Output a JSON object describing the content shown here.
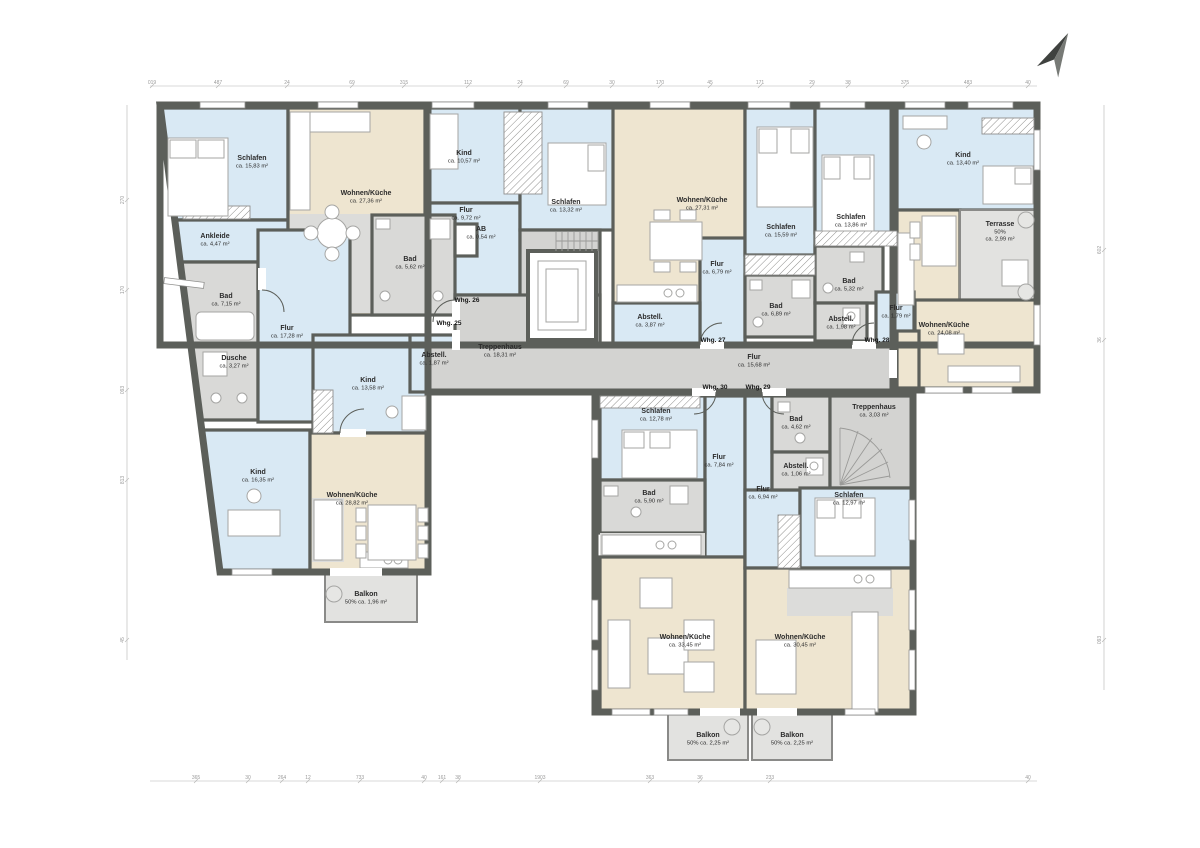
{
  "rooms": [
    {
      "id": "schlafen25",
      "name": "Schlafen",
      "area": "ca. 15,83 m²"
    },
    {
      "id": "wk25",
      "name": "Wohnen/Küche",
      "area": "ca. 27,36 m²"
    },
    {
      "id": "ankleide25",
      "name": "Ankleide",
      "area": "ca. 4,47 m²"
    },
    {
      "id": "bad25",
      "name": "Bad",
      "area": "ca. 7,15 m²"
    },
    {
      "id": "dusche25",
      "name": "Dusche",
      "area": "ca. 3,27 m²"
    },
    {
      "id": "flur25",
      "name": "Flur",
      "area": "ca. 17,28 m²"
    },
    {
      "id": "kind25a",
      "name": "Kind",
      "area": "ca. 13,58 m²"
    },
    {
      "id": "abstell25",
      "name": "Abstell.",
      "area": "ca. 1,87 m²"
    },
    {
      "id": "kind25b",
      "name": "Kind",
      "area": "ca. 16,35 m²"
    },
    {
      "id": "wk25b",
      "name": "Wohnen/Küche",
      "area": "ca. 28,82 m²"
    },
    {
      "id": "balkon25",
      "name": "Balkon",
      "area": "50% ca. 1,96 m²"
    },
    {
      "id": "kind26",
      "name": "Kind",
      "area": "ca. 10,57 m²"
    },
    {
      "id": "flur26",
      "name": "Flur",
      "area": "ca. 9,72 m²"
    },
    {
      "id": "ab26",
      "name": "AB",
      "area": "ca. 0,54 m²"
    },
    {
      "id": "bad26",
      "name": "Bad",
      "area": "ca. 5,62 m²"
    },
    {
      "id": "schlafen26",
      "name": "Schlafen",
      "area": "ca. 13,32 m²"
    },
    {
      "id": "treppenhaus",
      "name": "Treppenhaus",
      "area": "ca. 18,31 m²"
    },
    {
      "id": "wk27",
      "name": "Wohnen/Küche",
      "area": "ca. 27,31 m²"
    },
    {
      "id": "flur27",
      "name": "Flur",
      "area": "ca. 6,79 m²"
    },
    {
      "id": "abstell27",
      "name": "Abstell.",
      "area": "ca. 3,87 m²"
    },
    {
      "id": "schlafen27",
      "name": "Schlafen",
      "area": "ca. 15,59 m²"
    },
    {
      "id": "bad27",
      "name": "Bad",
      "area": "ca. 6,89 m²"
    },
    {
      "id": "schlafen28",
      "name": "Schlafen",
      "area": "ca. 13,86 m²"
    },
    {
      "id": "bad28",
      "name": "Bad",
      "area": "ca. 5,32 m²"
    },
    {
      "id": "abstell28",
      "name": "Abstell.",
      "area": "ca. 1,98 m²"
    },
    {
      "id": "kind28",
      "name": "Kind",
      "area": "ca. 13,40 m²"
    },
    {
      "id": "terrasse28",
      "name": "Terrasse",
      "area": "50%",
      "area2": "ca. 2,99 m²"
    },
    {
      "id": "flur28",
      "name": "Flur",
      "area": "ca. 1,79 m²"
    },
    {
      "id": "wk28",
      "name": "Wohnen/Küche",
      "area": "ca. 24,08 m²"
    },
    {
      "id": "flurC",
      "name": "Flur",
      "area": "ca. 15,68 m²"
    },
    {
      "id": "schlafen30",
      "name": "Schlafen",
      "area": "ca. 12,78 m²"
    },
    {
      "id": "flur30",
      "name": "Flur",
      "area": "ca. 7,84 m²"
    },
    {
      "id": "bad30",
      "name": "Bad",
      "area": "ca. 5,90 m²"
    },
    {
      "id": "wk30",
      "name": "Wohnen/Küche",
      "area": "ca. 33,45 m²"
    },
    {
      "id": "balkon30",
      "name": "Balkon",
      "area": "50% ca. 2,25 m²"
    },
    {
      "id": "bad29",
      "name": "Bad",
      "area": "ca. 4,62 m²"
    },
    {
      "id": "abstell29",
      "name": "Abstell.",
      "area": "ca. 1,06 m²"
    },
    {
      "id": "flur29",
      "name": "Flur",
      "area": "ca. 6,94 m²"
    },
    {
      "id": "treppenhaus29",
      "name": "Treppenhaus",
      "area": "ca. 3,03 m²"
    },
    {
      "id": "schlafen29",
      "name": "Schlafen",
      "area": "ca. 12,97 m²"
    },
    {
      "id": "wk29",
      "name": "Wohnen/Küche",
      "area": "ca. 30,45 m²"
    },
    {
      "id": "balkon29",
      "name": "Balkon",
      "area": "50% ca. 2,25 m²"
    }
  ],
  "units": [
    {
      "id": "whg25",
      "label": "Whg. 25"
    },
    {
      "id": "whg26",
      "label": "Whg. 26"
    },
    {
      "id": "whg27",
      "label": "Whg. 27"
    },
    {
      "id": "whg28",
      "label": "Whg. 28"
    },
    {
      "id": "whg30",
      "label": "Whg. 30"
    },
    {
      "id": "whg29",
      "label": "Whg. 29"
    }
  ],
  "dimensions": {
    "top": [
      "019",
      "487",
      "24",
      "69",
      "315",
      "112",
      "24",
      "69",
      "30",
      "170",
      "45",
      "171",
      "29",
      "38",
      "375",
      "483",
      "40"
    ],
    "bottom": [
      "365",
      "30",
      "264",
      "12",
      "733",
      "40",
      "161",
      "38",
      "1903",
      "363",
      "36",
      "233",
      "40"
    ],
    "left": [
      "270",
      "170",
      "093",
      "813",
      "45"
    ],
    "right": [
      "602",
      "36",
      "093"
    ]
  },
  "colors": {
    "wall": "#5c5f5a",
    "room_blue": "#d9e9f4",
    "room_beige": "#eee5d0",
    "room_gray": "#d9d9d7",
    "balcony": "#e2e2e0"
  }
}
